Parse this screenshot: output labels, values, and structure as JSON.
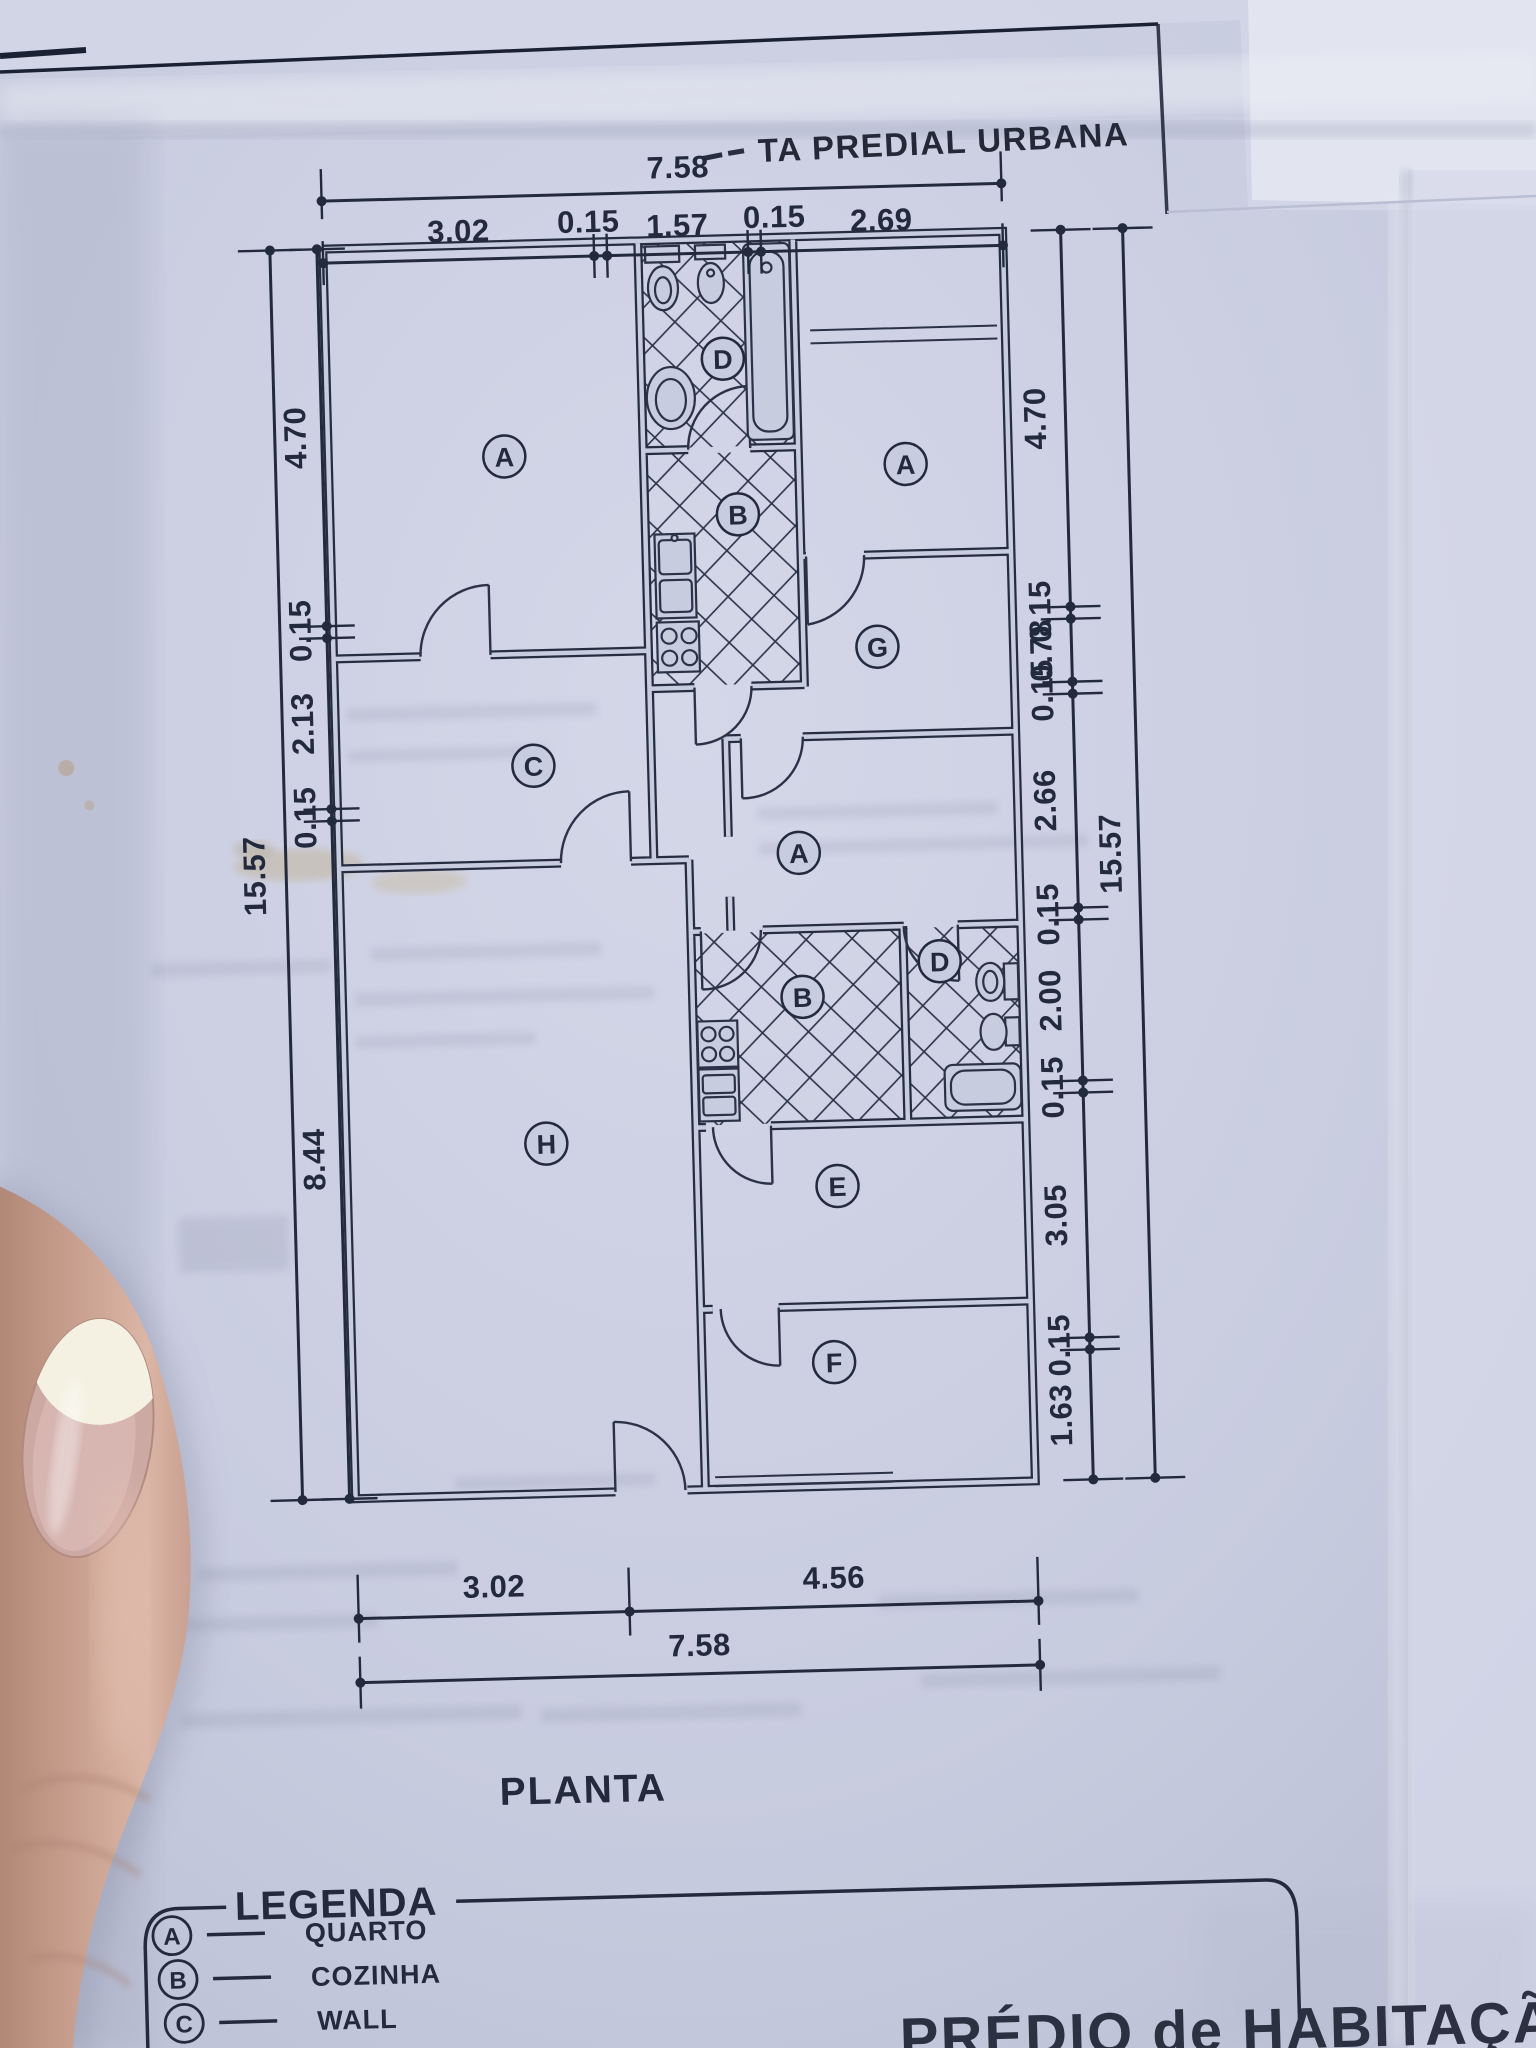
{
  "page": {
    "header_partial_text": "TA PREDIAL URBANA",
    "plan_title": "PLANTA",
    "footer_partial_text": "PRÉDIO de HABITAÇÃO"
  },
  "dimensions": {
    "top": {
      "total": "7.58",
      "segments": [
        "3.02",
        "0.15",
        "1.57",
        "0.15",
        "2.69"
      ]
    },
    "bottom": {
      "total": "7.58",
      "segments": [
        "3.02",
        "4.56"
      ]
    },
    "left": {
      "total": "15.57",
      "segments": [
        "4.70",
        "0.15",
        "2.13",
        "0.15",
        "8.44"
      ]
    },
    "right": {
      "total": "15.57",
      "segments": [
        "4.70",
        "0.15",
        "0.78",
        "0.15",
        "2.66",
        "0.15",
        "2.00",
        "0.15",
        "3.05",
        "0.15",
        "1.63"
      ]
    }
  },
  "room_labels": {
    "bedroom_top_left": "A",
    "bathroom_top": "D",
    "bedroom_top_right": "A",
    "kitchen_top": "B",
    "hall": "C",
    "corridor": "G",
    "bedroom_middle": "A",
    "kitchen_lower": "B",
    "bathroom_lower": "D",
    "room_h": "H",
    "room_e": "E",
    "room_f": "F"
  },
  "legend": {
    "title": "LEGENDA",
    "items": [
      {
        "key": "A",
        "label": "QUARTO"
      },
      {
        "key": "B",
        "label": "COZINHA"
      },
      {
        "key": "C",
        "label": "WALL"
      }
    ]
  },
  "colors": {
    "paper": "#c8ccdf",
    "ink": "#232a3e"
  }
}
